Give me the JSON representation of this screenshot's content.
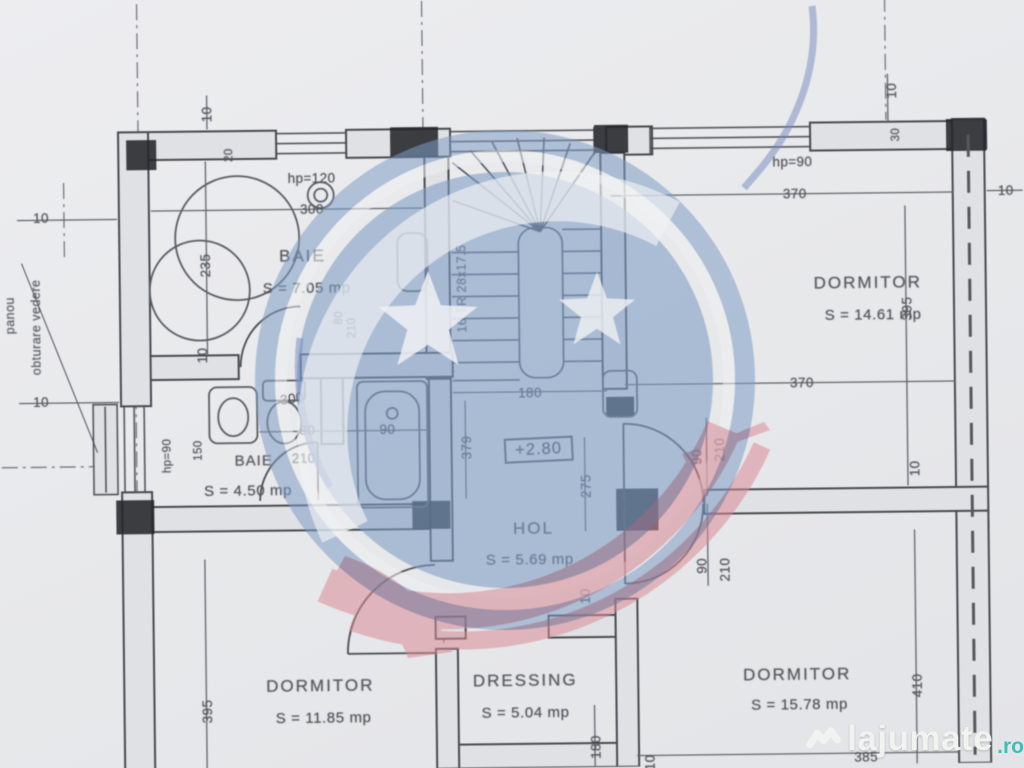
{
  "plan": {
    "rooms": {
      "baie1": {
        "name": "BAIE",
        "area": "S = 7.05 mp"
      },
      "dorm1": {
        "name": "DORMITOR",
        "area": "S = 14.61 mp"
      },
      "baie2": {
        "name": "BAIE",
        "area": "S = 4.50 mp"
      },
      "hol": {
        "name": "HOL",
        "area": "S = 5.69 mp"
      },
      "dorm2": {
        "name": "DORMITOR",
        "area": "S = 11.85 mp"
      },
      "dressing": {
        "name": "DRESSING",
        "area": "S = 5.04 mp"
      },
      "dorm3": {
        "name": "DORMITOR",
        "area": "S = 15.78 mp"
      }
    },
    "annotations": {
      "level": "+2.80",
      "stair": "16 TR 28x17.5",
      "panou_line1": "panou",
      "panou_line2": "obturare vedere"
    },
    "dims": {
      "d10_tl": "10",
      "d20_tl": "20",
      "hp120": "hp=120",
      "d300_baie": "300",
      "d235": "235",
      "d10_l1": "10",
      "d10_l2": "10",
      "d10_baieleft": "10",
      "d80_stairdoor": "80",
      "d210_stairdoor": "210",
      "d180_stair": "180",
      "hp90_top": "hp=90",
      "d370_top": "370",
      "d395_r": "395",
      "d10_tr": "10",
      "d30_tr": "30",
      "d10_re": "10",
      "d370_mid": "370",
      "d90_a": "90",
      "d210_a": "210",
      "d90_b": "90",
      "d210_b": "210",
      "d10_wall": "10",
      "hp90_left": "hp=90",
      "d150": "150",
      "d300_b": "300",
      "d80_a": "80",
      "d210_c": "210",
      "d90_tub": "90",
      "d379": "379",
      "d275": "275",
      "d10_hol": "10",
      "d395_l2": "395",
      "d180_dr": "180",
      "d410": "410",
      "d395_bot": "385",
      "d10_bot": "10"
    }
  },
  "watermark": {
    "brand": "lajumate",
    "tld": ".ro",
    "colors": {
      "blue": "#7e9cc4",
      "red": "#d98a95",
      "teal": "#2fbfb6",
      "text": "#f3f3f1"
    }
  }
}
